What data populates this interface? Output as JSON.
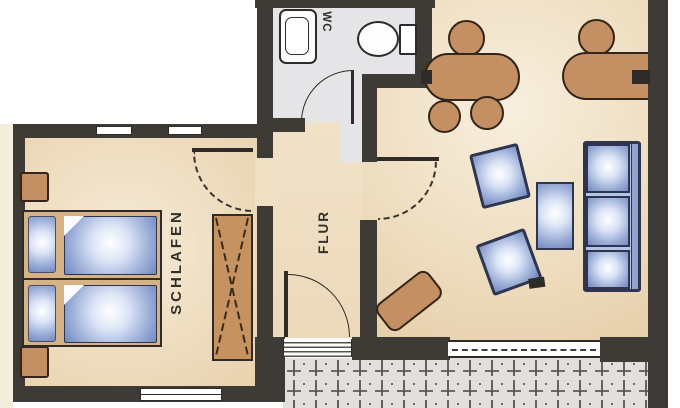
{
  "plan": {
    "rooms": [
      {
        "id": "wc",
        "label": "WC"
      },
      {
        "id": "schlafen",
        "label": "SCHLAFEN"
      },
      {
        "id": "flur",
        "label": "FLUR"
      }
    ],
    "colors": {
      "wall": "#3e3a36",
      "outline": "#2f2b28",
      "wood": "#c49063",
      "wood_line": "#33251a",
      "bed_frame": "#d6b287",
      "blue_edge": "#7288bf",
      "sofa_line": "#2e3550",
      "wc_floor": "#e5e5e7",
      "balcony_floor": "#e2e0dc",
      "floor_beige": "#eedcbe",
      "floor_light": "#f6ecd8"
    }
  }
}
